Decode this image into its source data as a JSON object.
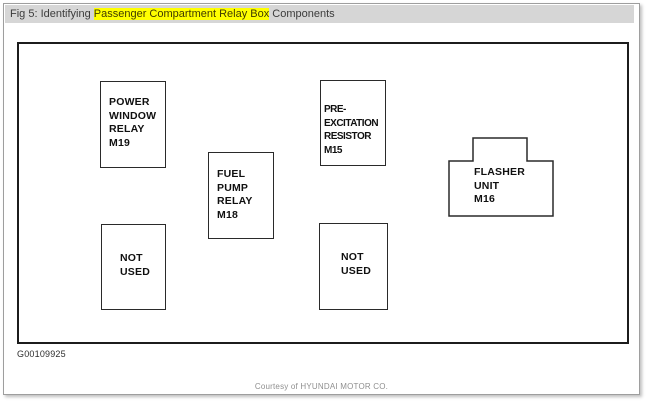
{
  "header": {
    "title_prefix": "Fig 5: Identifying ",
    "title_highlight": "Passenger Compartment Relay Box",
    "title_suffix": " Components"
  },
  "diagram": {
    "components": [
      {
        "id": "power-window-relay",
        "lines": [
          "POWER",
          "WINDOW",
          "RELAY",
          "M19"
        ]
      },
      {
        "id": "fuel-pump-relay",
        "lines": [
          "FUEL",
          "PUMP",
          "RELAY",
          "M18"
        ]
      },
      {
        "id": "pre-excitation-resistor",
        "lines": [
          "PRE-",
          "EXCITATION",
          "RESISTOR",
          "M15"
        ]
      },
      {
        "id": "flasher-unit",
        "lines": [
          "FLASHER",
          "UNIT",
          "M16"
        ]
      },
      {
        "id": "not-used-left",
        "lines": [
          "NOT",
          "USED"
        ]
      },
      {
        "id": "not-used-right",
        "lines": [
          "NOT",
          "USED"
        ]
      }
    ]
  },
  "footer": {
    "figure_id": "G00109925",
    "credit": "Courtesy of HYUNDAI MOTOR CO."
  },
  "colors": {
    "highlight": "#ffff00",
    "title_bar_bg": "#d6d6d6",
    "title_text": "#3c3c3c",
    "diagram_line": "#1c1c1c",
    "credit_text": "#8f8f8f"
  }
}
